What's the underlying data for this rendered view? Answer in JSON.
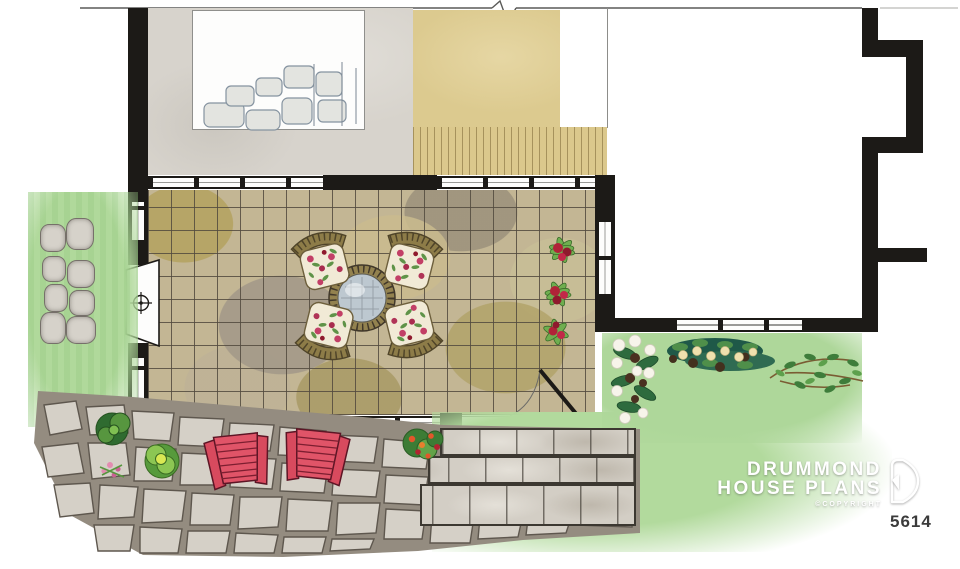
{
  "branding": {
    "name_line1": "DRUMMOND",
    "name_line2": "HOUSE PLANS",
    "copyright": "©COPYRIGHT",
    "plan_number": "5614"
  },
  "palette": {
    "wall_black": "#1c1a17",
    "concrete_gray": "#d7d3cc",
    "deck_tan": "#dbc88c",
    "patio_tile_base": "#c3b694",
    "grass_green": "#b2da9d",
    "flagstone_gray": "#cfc9bf",
    "adirondack_red": "#d84a5e",
    "table_glass_blue": "#bdc8d0",
    "wicker_olive": "#8d7c48",
    "foliage_green": "#3f7a38",
    "flower_crimson": "#b02438"
  }
}
